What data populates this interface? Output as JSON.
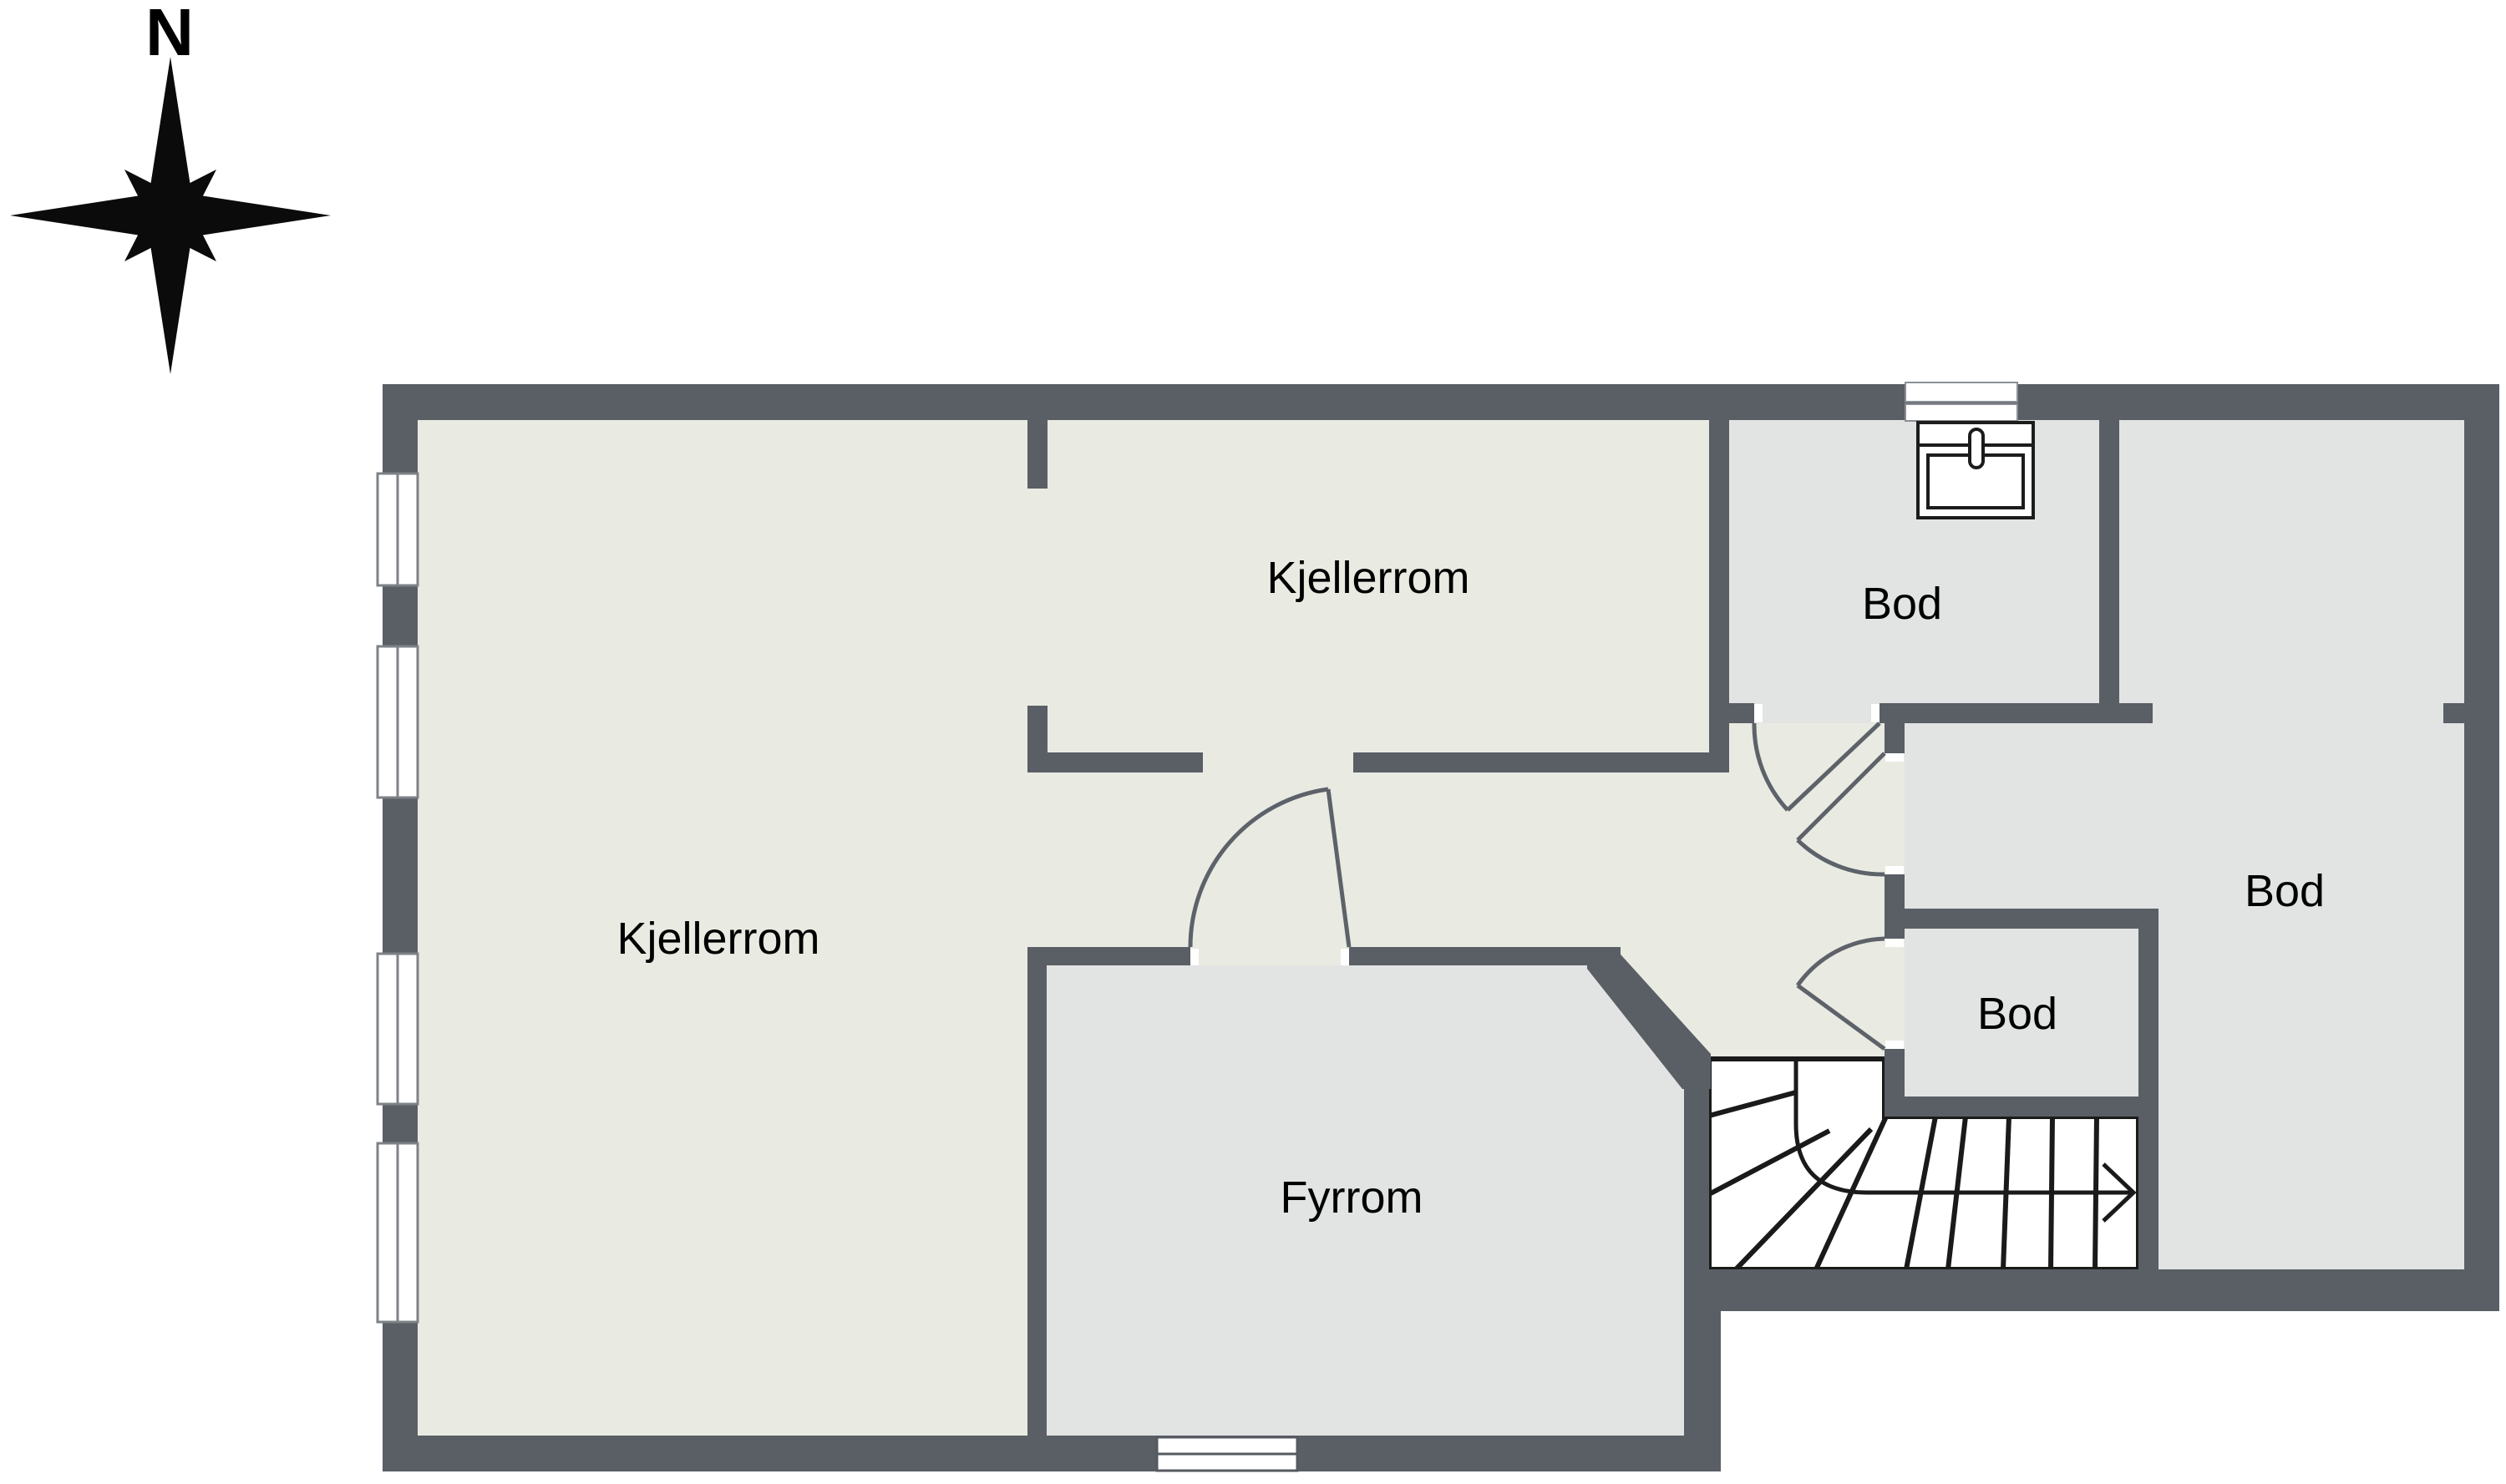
{
  "compass": {
    "label": "N"
  },
  "rooms": [
    {
      "id": "kjellerrom-left",
      "label": "Kjellerrom"
    },
    {
      "id": "kjellerrom-top",
      "label": "Kjellerrom"
    },
    {
      "id": "bod-top",
      "label": "Bod"
    },
    {
      "id": "bod-right",
      "label": "Bod"
    },
    {
      "id": "bod-small",
      "label": "Bod"
    },
    {
      "id": "fyrrom",
      "label": "Fyrrom"
    }
  ],
  "fixtures": {
    "sink_icon": "sink-with-faucet",
    "chimney_icon": "chimney-hatch",
    "stairs_icon": "winder-staircase-with-direction-arrow",
    "compass_icon": "compass-rose-8-point"
  },
  "windows": {
    "left_wall_count": 4,
    "bottom_wall_count": 1
  },
  "doors_count": 4,
  "colors": {
    "wall": "#5a5e65",
    "floor_main": "#e9eae1",
    "floor_rooms": "#e2e3e3",
    "background": "#ffffff",
    "stair_lines": "#1a1a1a",
    "door_lines": "#5d626a",
    "window_frame": "#7d8287",
    "text": "#000000"
  }
}
